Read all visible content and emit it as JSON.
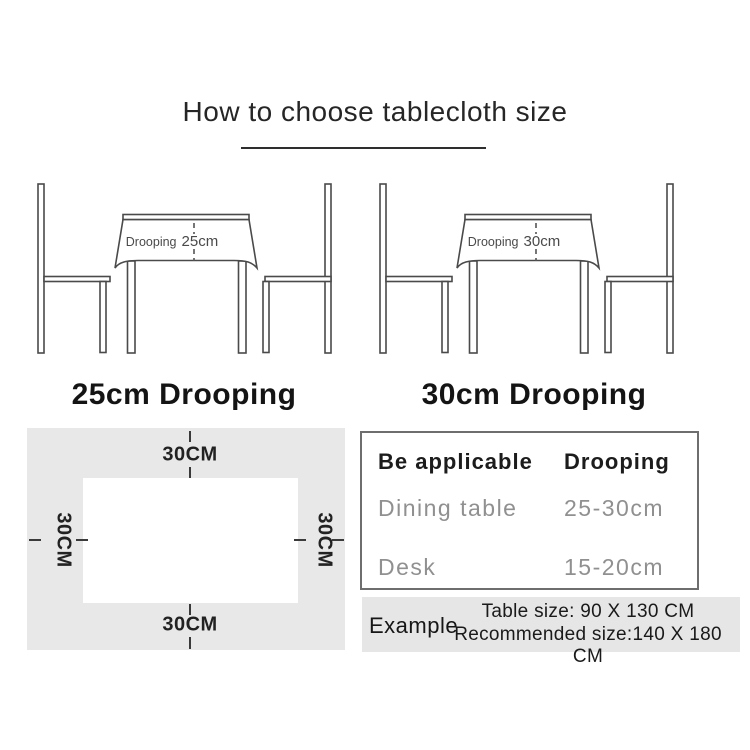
{
  "title": {
    "text": "How to choose tablecloth size"
  },
  "diagrams": [
    {
      "droop_word": "Drooping",
      "droop_value": "25cm",
      "caption": "25cm Drooping"
    },
    {
      "droop_word": "Drooping",
      "droop_value": "30cm",
      "caption": "30cm Drooping"
    }
  ],
  "dimension_panel": {
    "top_label": "30CM",
    "bottom_label": "30CM",
    "left_label": "30CM",
    "right_label": "30CM"
  },
  "size_table": {
    "headers": [
      "Be applicable",
      "Drooping"
    ],
    "rows": [
      [
        "Dining table",
        "25-30cm"
      ],
      [
        "Desk",
        "15-20cm"
      ]
    ]
  },
  "example": {
    "label": "Example",
    "table_size_line": "Table size: 90 X 130 CM",
    "recommended_line": "Recommended size:140 X 180 CM"
  },
  "colors": {
    "line_art": "#4a4a4a",
    "panel_bg": "#e8e8e8",
    "example_bg": "#e6e6e6",
    "table_border": "#6e6e6e",
    "muted_text": "#909090",
    "dash": "#3a3a3a",
    "text": "#1a1a1a"
  }
}
